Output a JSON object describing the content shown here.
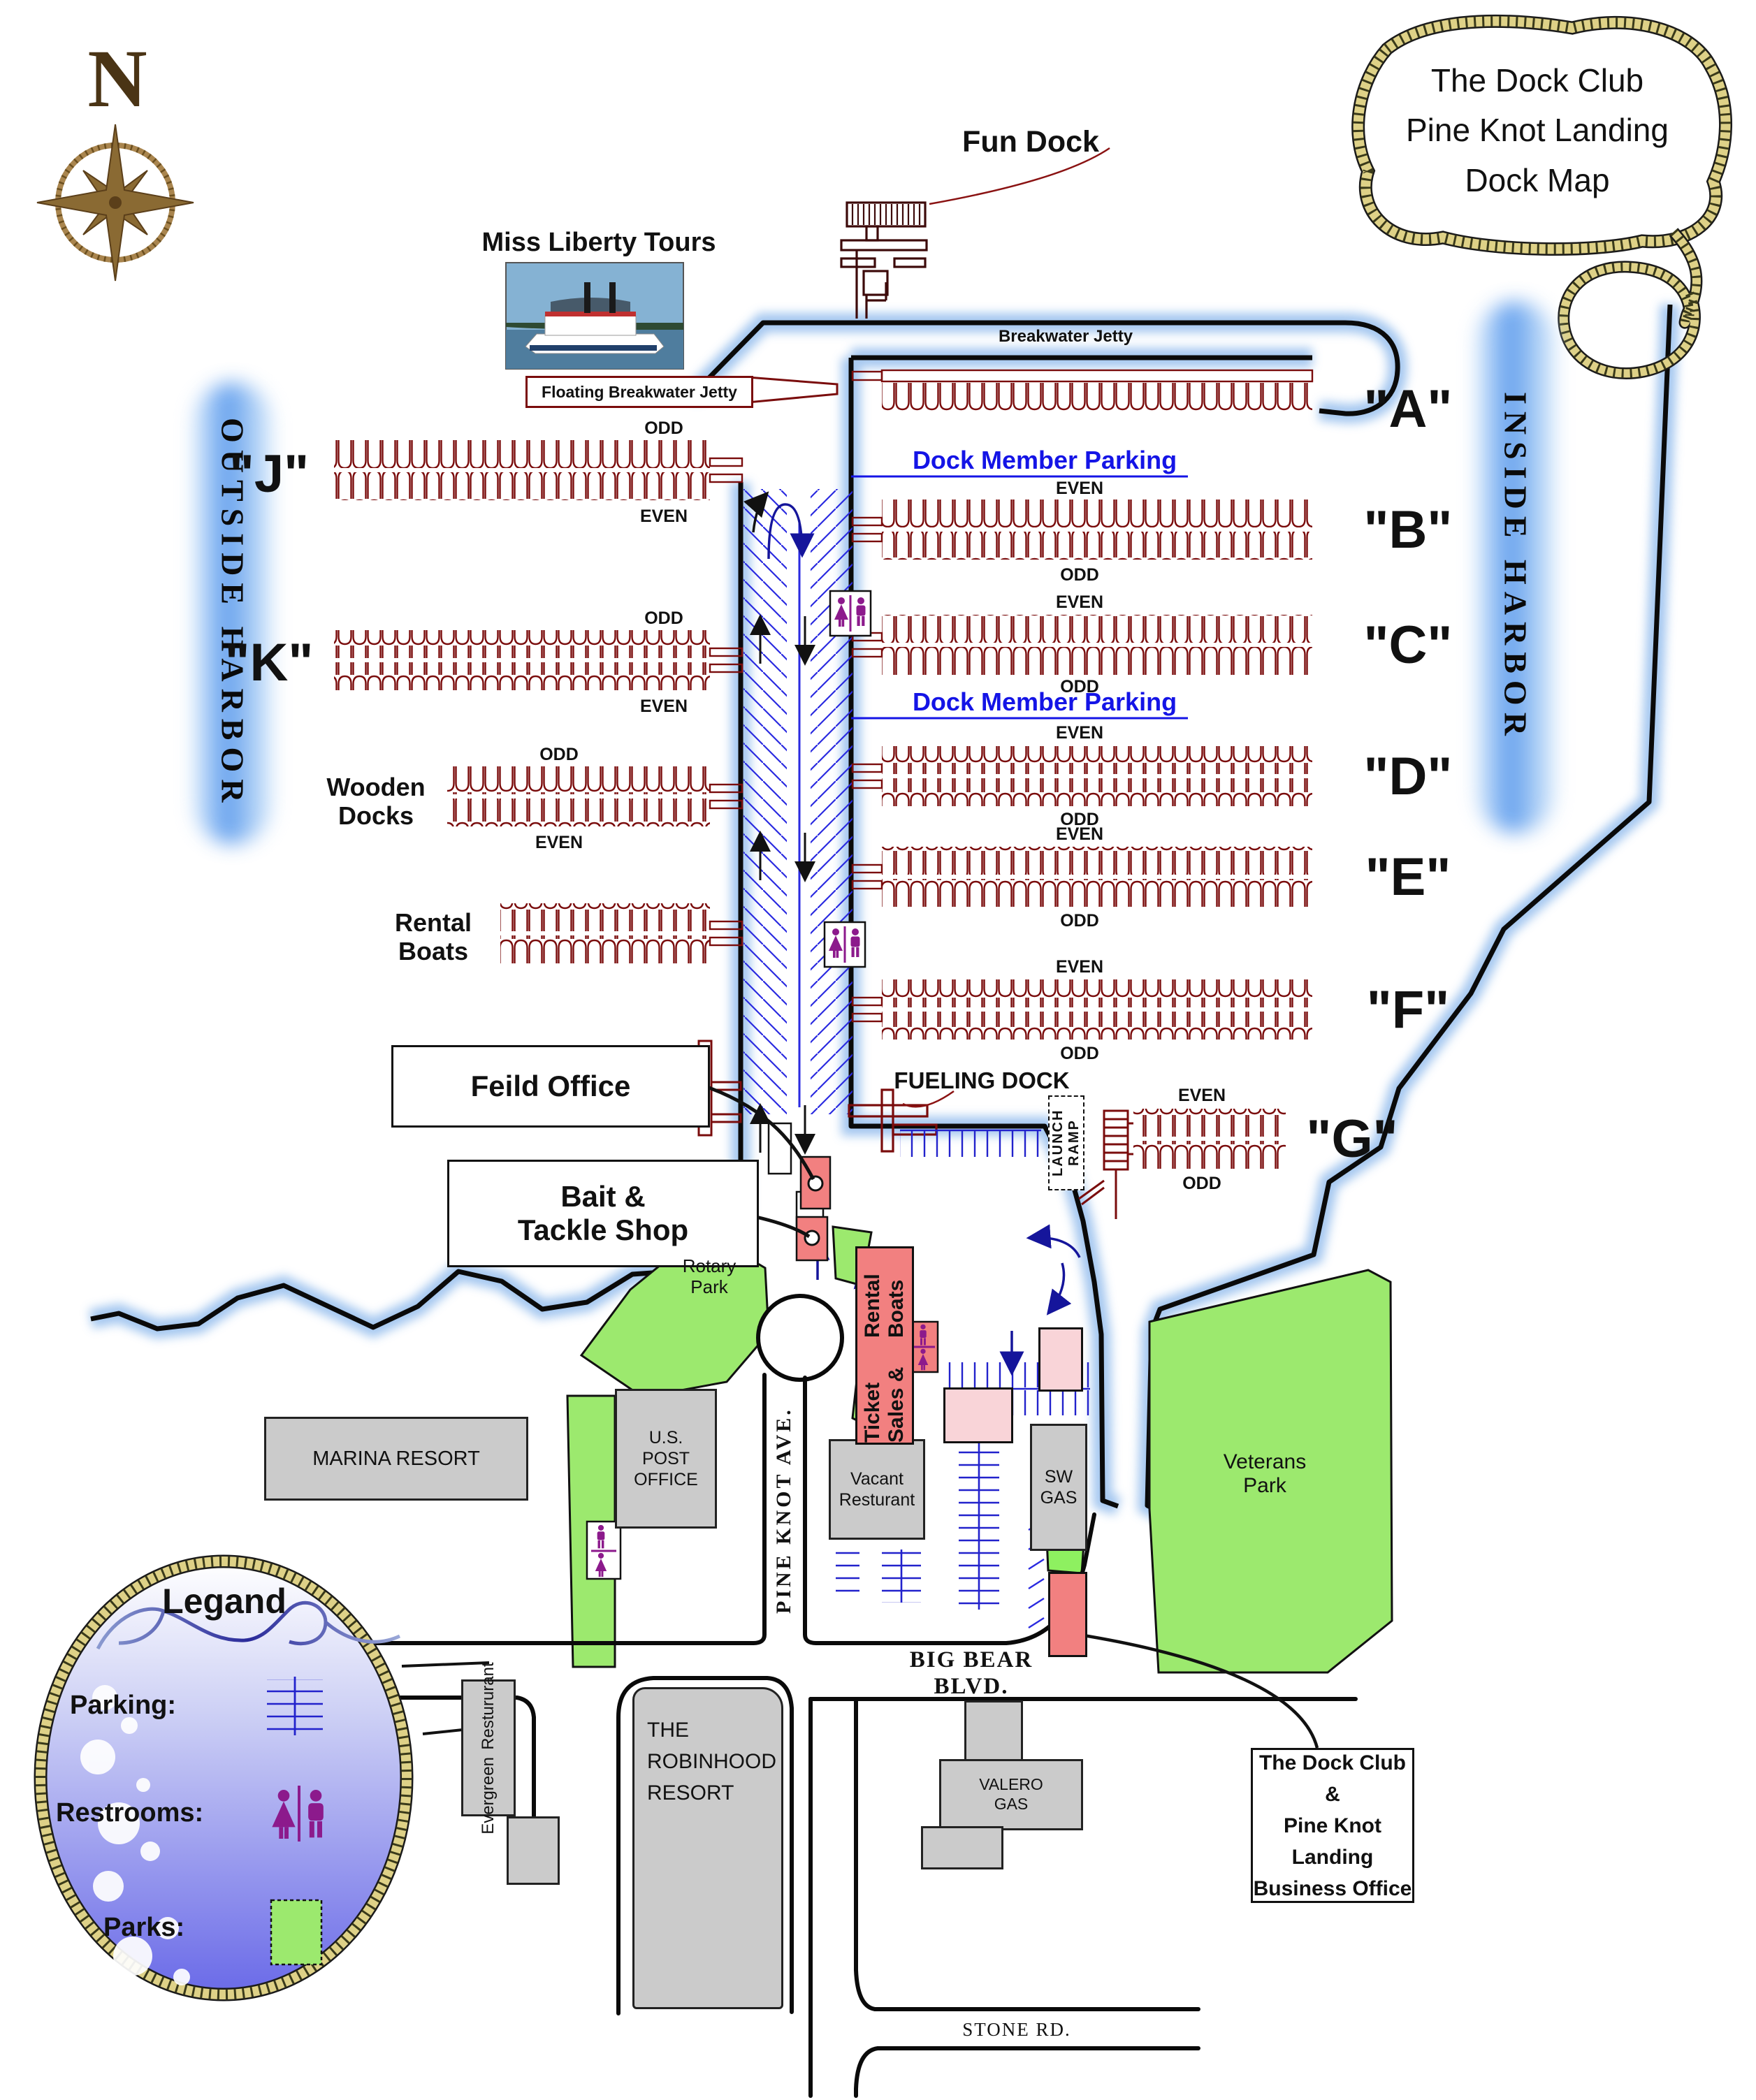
{
  "map": {
    "title_lines": [
      "The Dock Club",
      "Pine Knot Landing",
      "Dock Map"
    ],
    "compass": "N"
  },
  "harbor": {
    "outside": "OUTSIDE HARBOR",
    "inside": "INSIDE HARBOR"
  },
  "top": {
    "fun_dock": "Fun Dock",
    "miss_liberty_tours": "Miss Liberty Tours",
    "floating_breakwater_jetty": "Floating Breakwater Jetty",
    "breakwater_jetty": "Breakwater Jetty"
  },
  "fairway": {
    "dock_member_parking_1": "Dock Member Parking",
    "dock_member_parking_2": "Dock Member Parking",
    "fueling_dock": "FUELING DOCK",
    "launch_ramp": "LAUNCH RAMP"
  },
  "docks_right": [
    {
      "id": "A",
      "label": "\"A\""
    },
    {
      "id": "B",
      "label": "\"B\"",
      "even": "EVEN",
      "odd": "ODD"
    },
    {
      "id": "C",
      "label": "\"C\"",
      "even": "EVEN",
      "odd": "ODD"
    },
    {
      "id": "D",
      "label": "\"D\"",
      "even": "EVEN",
      "odd": "ODD"
    },
    {
      "id": "E",
      "label": "\"E\"",
      "even": "EVEN",
      "odd": "ODD"
    },
    {
      "id": "F",
      "label": "\"F\"",
      "even": "EVEN",
      "odd": "ODD"
    },
    {
      "id": "G",
      "label": "\"G\"",
      "even": "EVEN",
      "odd": "ODD"
    }
  ],
  "docks_left": [
    {
      "id": "J",
      "label": "\"J\"",
      "odd": "ODD",
      "even": "EVEN"
    },
    {
      "id": "K",
      "label": "\"K\"",
      "odd": "ODD",
      "even": "EVEN"
    },
    {
      "id": "wooden",
      "label_lines": [
        "Wooden",
        "Docks"
      ],
      "odd": "ODD",
      "even": "EVEN"
    },
    {
      "id": "rental",
      "label_lines": [
        "Rental",
        "Boats"
      ]
    }
  ],
  "callouts": {
    "feild_office": "Feild Office",
    "bait_tackle_lines": [
      "Bait &",
      "Tackle Shop"
    ],
    "business_office_lines": [
      "The Dock Club &",
      "Pine Knot Landing",
      "Business Office"
    ]
  },
  "places": {
    "rotary_park_lines": [
      "Rotary",
      "Park"
    ],
    "marina_resort": "MARINA RESORT",
    "post_office_lines": [
      "U.S.",
      "POST",
      "OFFICE"
    ],
    "ticket_sales_lines": [
      "Ticket Sales &",
      "Rental Boats"
    ],
    "vacant_resturant_lines": [
      "Vacant",
      "Resturant"
    ],
    "sw_gas_lines": [
      "SW",
      "GAS"
    ],
    "veterans_park_lines": [
      "Veterans",
      "Park"
    ],
    "evergreen_lines": [
      "Evergreen",
      "Restururant"
    ],
    "robinhood_lines": [
      "THE",
      "ROBINHOOD",
      "RESORT"
    ],
    "valero_lines": [
      "VALERO",
      "GAS"
    ]
  },
  "streets": {
    "pine_knot_ave": "PINE KNOT AVE.",
    "big_bear_blvd": "BIG BEAR BLVD.",
    "stone_rd": "STONE RD."
  },
  "legend": {
    "title": "Legand",
    "parking": "Parking:",
    "restrooms": "Restrooms:",
    "parks": "Parks:"
  },
  "colors": {
    "dock_red": "#7a0c0c",
    "parking_blue": "#2222cc",
    "member_parking_text": "#1414e6",
    "water_glow": "#8fbaec",
    "park_green": "#9ce96e",
    "building_gray": "#cbcbcb",
    "building_salmon": "#f28080",
    "building_pink": "#f9d4d8",
    "rope_tan": "#ded187",
    "restroom_purple": "#8c1a8c"
  }
}
